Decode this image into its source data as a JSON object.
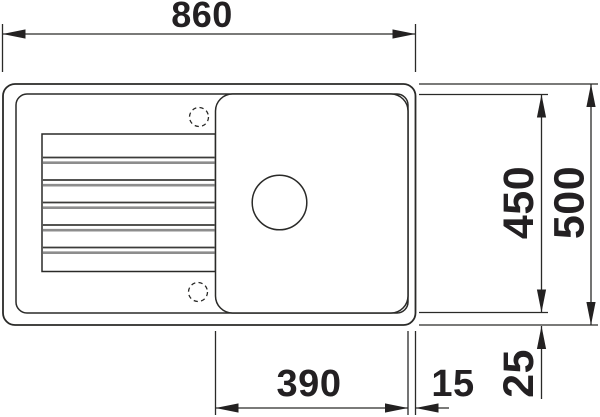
{
  "page": {
    "background": "#ffffff"
  },
  "drawing": {
    "type": "technical-drawing-top-view",
    "subject": "inset kitchen sink with drainboard and single round-drain bowl",
    "units": "mm",
    "colors": {
      "line": "#2a2a28",
      "label": "#232022",
      "ridge_gray": "#8d8d8d",
      "background": "#ffffff"
    },
    "dimensions": {
      "overall_width": "860",
      "overall_depth": "500",
      "inner_field_depth": "450",
      "bowl_width": "390",
      "bowl_to_right_edge": "15",
      "inner_field_to_bottom_edge": "25"
    }
  }
}
